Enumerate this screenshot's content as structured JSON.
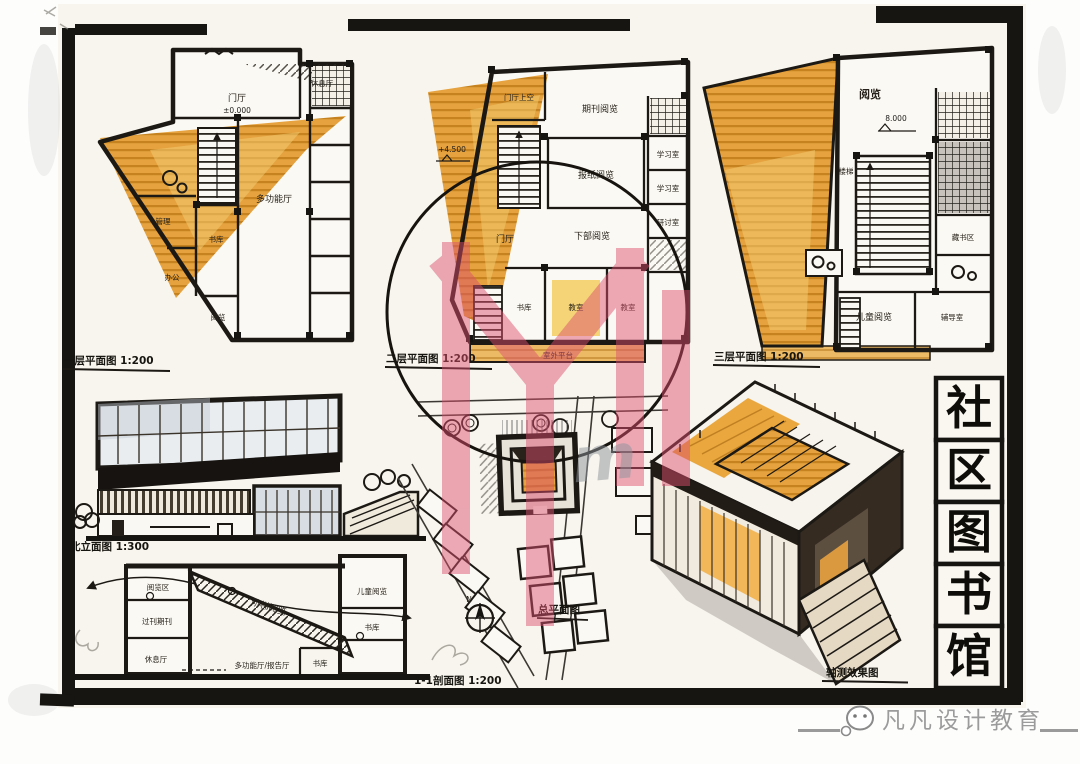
{
  "title_block": {
    "chars": [
      "社",
      "区",
      "图",
      "书",
      "馆"
    ]
  },
  "plans": {
    "floor1": {
      "caption": "一层平面图 1:200",
      "level": "±0.000",
      "rooms": {
        "entry": "门厅",
        "lounge": "休息厅",
        "multi_hall": "多功能厅",
        "stack": "书库",
        "admin": "管理",
        "office": "办公",
        "reading": "阅览"
      }
    },
    "floor2": {
      "caption": "二层平面图 1:200",
      "level": "+4.500",
      "rooms": {
        "void": "门厅上空",
        "hall": "门厅",
        "periodicals": "期刊阅览",
        "newspapers": "报纸阅览",
        "lower_reading": "下部阅览",
        "study1": "学习室",
        "study2": "学习室",
        "seminar": "研讨室",
        "stack": "书库",
        "class1": "教室",
        "class2": "教室",
        "terrace": "室外平台"
      }
    },
    "floor3": {
      "caption": "三层平面图 1:200",
      "level": "8.000",
      "rooms": {
        "reading": "阅览",
        "stair": "楼梯",
        "stacks": "藏书区",
        "children": "儿童阅览",
        "tutoring": "辅导室"
      }
    }
  },
  "elevation": {
    "caption": "北立面图 1:300"
  },
  "section": {
    "caption": "1-1剖面图 1:200",
    "labels": {
      "reading_zone": "阅览区",
      "back_issues": "过刊期刊",
      "lounge": "休息厅",
      "stepped_reading": "阶梯阅览",
      "multi_hall": "多功能厅/报告厅",
      "children": "儿童阅览",
      "stack_mid": "书库",
      "stack_low": "书库"
    }
  },
  "site": {
    "caption": "总平面图",
    "north": "N"
  },
  "axon": {
    "caption": "轴测效果图"
  },
  "brand": {
    "name": "凡凡设计教育",
    "monogram": "m"
  },
  "colors": {
    "ink": "#1c1915",
    "marker_orange": "#e29c3b",
    "marker_yellow": "#f2cf6b",
    "logo_pink": "#dd5570"
  }
}
